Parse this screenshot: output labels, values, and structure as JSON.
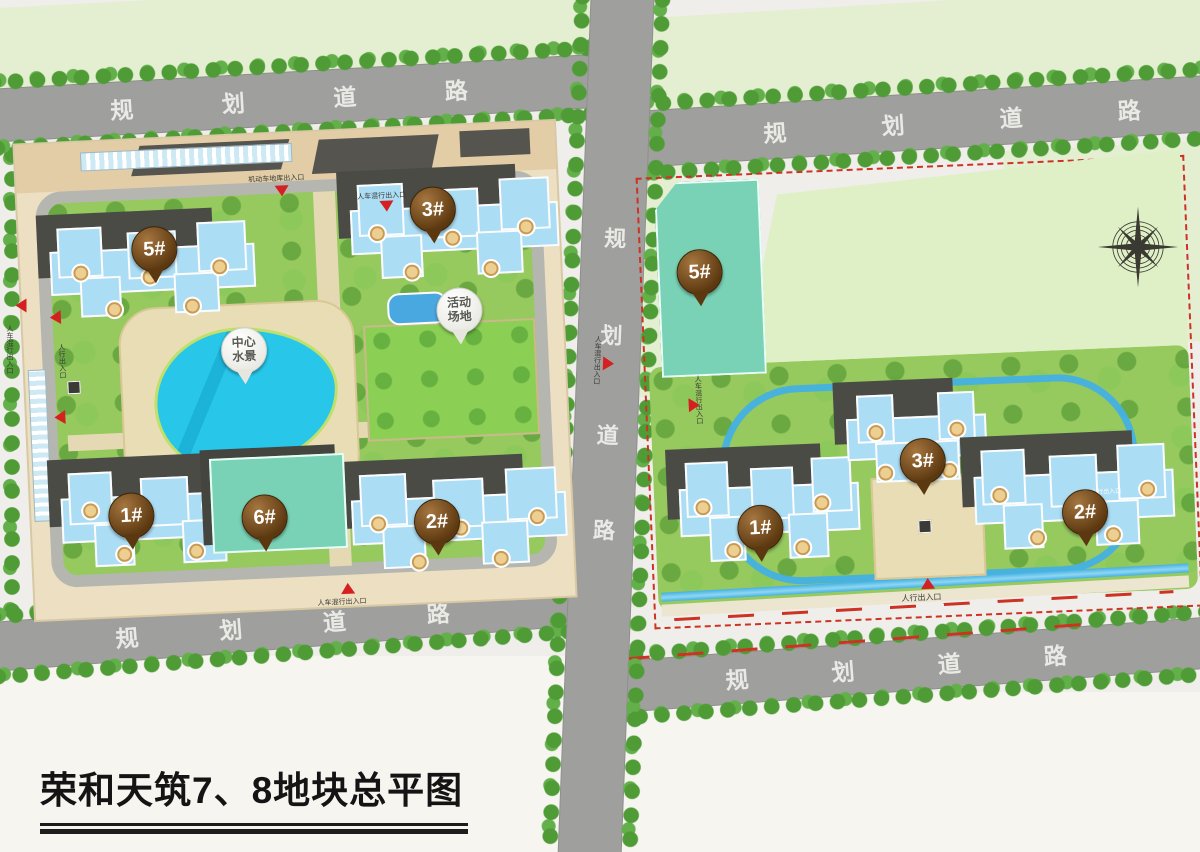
{
  "title": "荣和天筑7、8地块总平图",
  "roads": {
    "label": "规划道路",
    "chars": [
      "规",
      "划",
      "道",
      "路"
    ]
  },
  "left_plot": {
    "markers": {
      "b5": "5#",
      "b3": "3#",
      "b1": "1#",
      "b6": "6#",
      "b2": "2#"
    },
    "poi": {
      "center_water": "中心水景",
      "activity_ground": "活动场地"
    }
  },
  "right_plot": {
    "markers": {
      "b5": "5#",
      "b3": "3#",
      "b1": "1#",
      "b2": "2#"
    }
  },
  "entrances": {
    "garage": "机动车地库出入口",
    "mixed": "人车混行出入口",
    "pedestrian": "人行出入口"
  }
}
